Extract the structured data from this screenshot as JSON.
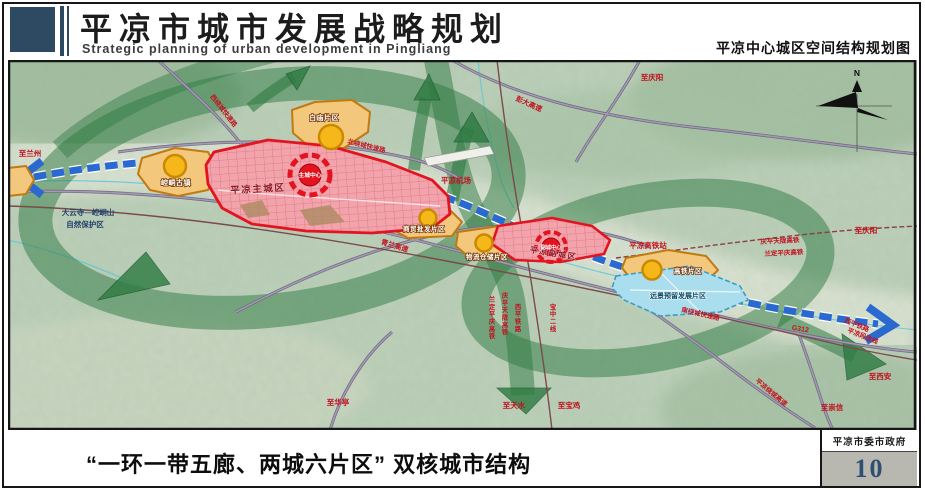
{
  "header": {
    "title_cn": "平凉市城市发展战略规划",
    "title_en": "Strategic planning of urban development in Pingliang",
    "sheet_title": "平凉中心城区空间结构规划图"
  },
  "footer": {
    "caption": "“一环一带五廊、两城六片区” 双核城市结构",
    "agency": "平凉市委市政府",
    "page_number": "10"
  },
  "map": {
    "compass_label": "N",
    "zones": {
      "main_city": "平凉主城区",
      "main_center": "主城中心",
      "sub_city": "平凉副城区",
      "sub_center": "副城中心",
      "baimiao": "白庙片区",
      "ancient_town": "崆峒古镇",
      "trade": "商贸批发片区",
      "logistics": "物流仓储片区",
      "hsr_district": "高铁片区",
      "reserve": "远景预留发展片区"
    },
    "places": {
      "nature_line1": "大云寺—崆峒山",
      "nature_line2": "自然保护区",
      "airport": "平凉机场",
      "hsr_station": "平凉高铁站"
    },
    "roads": {
      "pengda": "彭大高速",
      "west_ring": "西绕城快速路",
      "north_ring": "北绕城快速路",
      "qinglan": "青兰高速",
      "south_ring": "南绕城快速路",
      "g312": "G312",
      "city_ring": "平凉绕城高速"
    },
    "rails": {
      "qptl_ne": "庆平天陇高铁",
      "ldpq_ne": "兰定平庆高铁",
      "xiping_se": "西平铁路",
      "xiping_se2": "平凉段改线",
      "xiping_v": "西平铁路",
      "qptl_v": "庆平天陇高铁",
      "ldpq_v": "兰定平庆高铁",
      "baozhong_v": "宝中二线"
    },
    "destinations": {
      "lanzhou": "至兰州",
      "qingyang_n": "至庆阳",
      "qingyang_e": "至庆阳",
      "xian": "至西安",
      "chongxin": "至崇信",
      "tianshui": "至天水",
      "baoji": "至宝鸡",
      "huating": "至华亭"
    }
  },
  "colors": {
    "brand_dark_blue": "#2e4a63",
    "axis_blue": "#2a6ad0",
    "eco_green": "#2e7a42",
    "zone_red": "#e3131f",
    "zone_orange": "#c07a10",
    "reserve_blue": "#aadded",
    "label_red": "#c1121f",
    "page_number_blue": "#2e4e72"
  }
}
